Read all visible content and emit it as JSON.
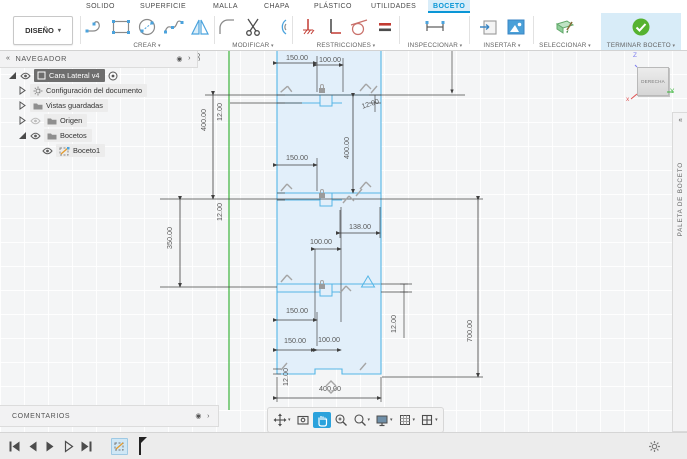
{
  "app": {
    "design_menu": "DISEÑO",
    "tabs": [
      "SOLIDO",
      "SUPERFICIE",
      "MALLA",
      "CHAPA",
      "PLÁSTICO",
      "UTILIDADES",
      "BOCETO"
    ],
    "active_tab": "BOCETO",
    "groups": [
      "CREAR",
      "MODIFICAR",
      "RESTRICCIONES",
      "INSPECCIONAR",
      "INSERTAR",
      "SELECCIONAR",
      "TERMINAR BOCETO"
    ]
  },
  "navigator": {
    "title": "NAVEGADOR",
    "items": [
      {
        "label": "Cara Lateral v4"
      },
      {
        "label": "Configuración del documento"
      },
      {
        "label": "Vistas guardadas"
      },
      {
        "label": "Origen"
      },
      {
        "label": "Bocetos"
      },
      {
        "label": "Boceto1"
      }
    ]
  },
  "comments": {
    "label": "COMENTARIOS"
  },
  "viewcube": {
    "face": "DERECHA",
    "axis_z": "Z",
    "axis_y": "Y",
    "axis_x": "x"
  },
  "right_panel": {
    "label": "PALETA DE BOCETO"
  },
  "icons": {
    "collapse_double_left": "«",
    "chevron_right": "›",
    "target_dot": "◉",
    "caret_down": "▾"
  },
  "sketch": {
    "dims": [
      "150.00",
      "100.00",
      "400.00",
      "12.00",
      "400.00",
      "12.00",
      "150.00",
      "350.00",
      "12.00",
      "138.00",
      "100.00",
      "12.00",
      "150.00",
      "150.00",
      "100.00",
      "12.00",
      "400.00",
      "700.00",
      "30"
    ]
  },
  "colors": {
    "accent_blue": "#0a96d6",
    "active_tab_bg": "#d9edf9",
    "terminar_bg": "#d8ecf8",
    "check_green": "#56b230",
    "sketch_line": "#55b6e6",
    "sketch_fill": "#e2effa",
    "axis_green": "#3cb43c",
    "dim_gray": "#585858",
    "constraint_gray": "#a5a5a5"
  }
}
